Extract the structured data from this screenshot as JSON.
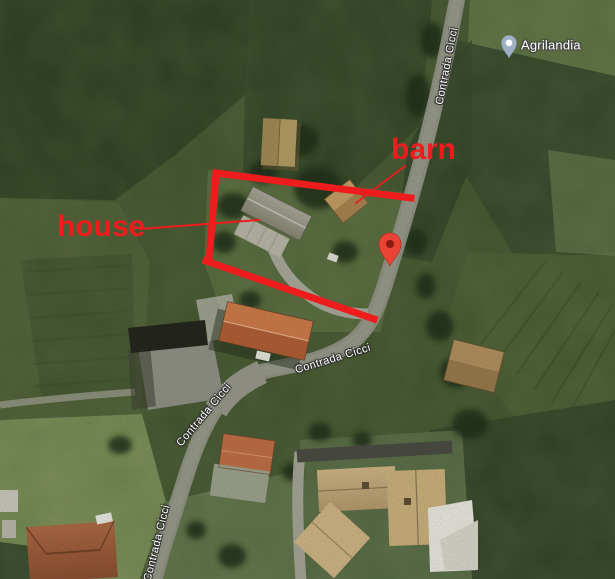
{
  "map": {
    "poi": {
      "name": "Agrilandia"
    },
    "road_name": "Contrada Cicci",
    "annotations": {
      "barn": "barn",
      "house": "house"
    }
  },
  "colors": {
    "annotation_red": "#ee1c1c",
    "pin_red": "#e94335",
    "pin_red_dark": "#8e1b12",
    "poi_pin_fill": "#9fb0c4"
  }
}
